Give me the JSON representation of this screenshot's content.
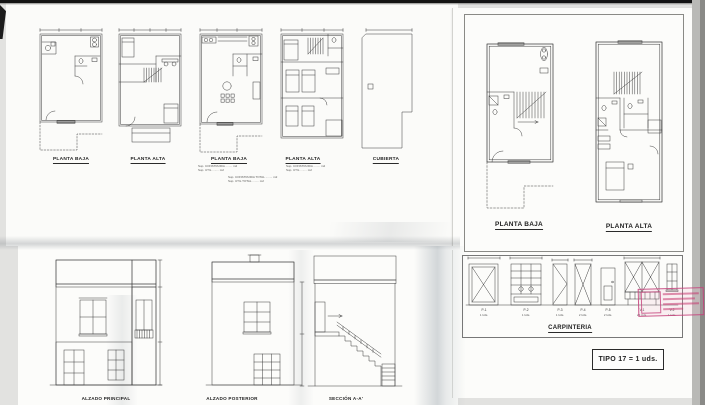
{
  "colors": {
    "paper": "#fcfcfa",
    "ink": "#3b3b3b",
    "stamp_pink": "#c4457a",
    "shadow_gray": "#aeb2b6"
  },
  "top_left_sheet": {
    "plans": [
      {
        "label": "PLANTA BAJA"
      },
      {
        "label": "PLANTA ALTA"
      },
      {
        "label": "PLANTA BAJA"
      },
      {
        "label": "PLANTA ALTA"
      },
      {
        "label": "CUBIERTA"
      }
    ],
    "area_notes_plan3": [
      "Sup. CONSTRUIDA ........ m2",
      "Sup. UTIL ........ m2"
    ],
    "area_notes_plan4": [
      "Sup. CONSTRUIDA ........ m2",
      "Sup. UTIL ........ m2"
    ],
    "area_notes_totals": [
      "Sup. CONSTRUIDA TOTAL ........ m2",
      "Sup. UTIL TOTAL ........ m2"
    ]
  },
  "top_right_sheet": {
    "plans": [
      {
        "label": "PLANTA BAJA"
      },
      {
        "label": "PLANTA ALTA"
      }
    ]
  },
  "bottom_left_sheet": {
    "elevations": [
      {
        "label": "ALZADO PRINCIPAL"
      },
      {
        "label": "ALZADO POSTERIOR"
      },
      {
        "label": "SECCIÓN A-A'"
      }
    ]
  },
  "carpentry_sheet": {
    "title": "CARPINTERIA",
    "items": [
      {
        "code": "P-1",
        "count": "1 Uds."
      },
      {
        "code": "P-2",
        "count": "1 Uds."
      },
      {
        "code": "P-3",
        "count": "1 Uds."
      },
      {
        "code": "P-4",
        "count": "2 Uds."
      },
      {
        "code": "P-5",
        "count": "2 Uds."
      },
      {
        "code": "V-1",
        "count": "22 Uds."
      },
      {
        "code": "V-2",
        "count": "1 Uds."
      }
    ],
    "type_box": "TIPO 17  = 1 uds."
  }
}
